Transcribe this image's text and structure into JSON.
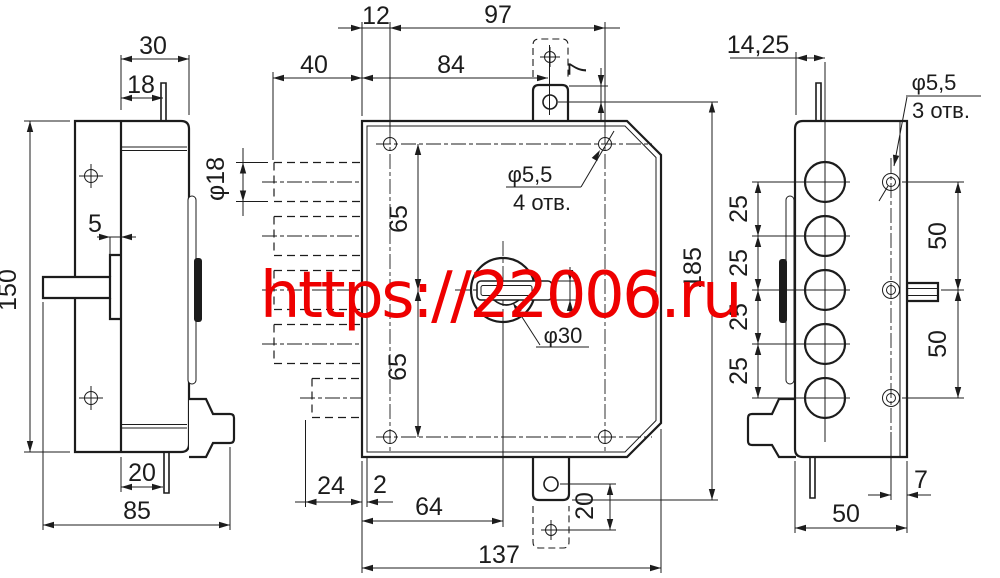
{
  "title": "lock housing technical drawing",
  "colors": {
    "line": "#1c1c1c",
    "watermark": "#ee0000",
    "background": "#ffffff"
  },
  "watermark": {
    "text": "https://22006.ru"
  },
  "views": {
    "left": {
      "label": "left-side-view",
      "d30": "30",
      "d18": "18",
      "d5": "5",
      "d150": "150",
      "d20": "20",
      "d85": "85"
    },
    "front": {
      "label": "front-view",
      "d12": "12",
      "d97": "97",
      "d40": "40",
      "d84": "84",
      "d7": "7",
      "dia18": "φ18",
      "d65a": "65",
      "d65b": "65",
      "dia55": "φ5,5",
      "holes4": "4 отв.",
      "dia30": "φ30",
      "d185": "185",
      "d24": "24",
      "d2": "2",
      "d64": "64",
      "d20": "20",
      "d137": "137"
    },
    "right": {
      "label": "right-side-view",
      "d1425": "14,25",
      "dia55": "φ5,5",
      "holes3": "3 отв.",
      "d25a": "25",
      "d25b": "25",
      "d25c": "25",
      "d25d": "25",
      "d50a": "50",
      "d50b": "50",
      "d7": "7",
      "d50c": "50"
    }
  }
}
